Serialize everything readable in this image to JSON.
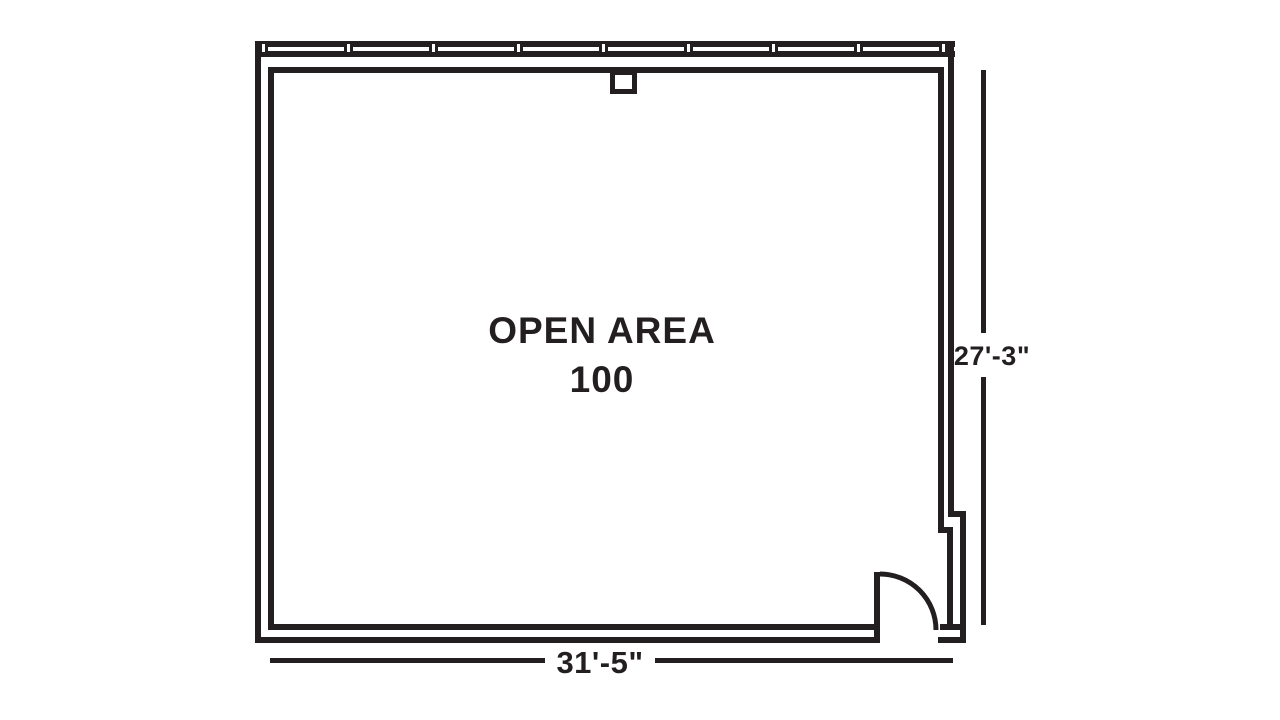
{
  "canvas": {
    "background": "#ffffff",
    "line_color": "#231f20"
  },
  "floor_plan": {
    "room": {
      "label": "OPEN AREA",
      "number": "100"
    },
    "dimensions": {
      "width_label": "31'-5\"",
      "height_label": "27'-3\""
    },
    "window_wall": {
      "mullion_count": 9
    }
  }
}
